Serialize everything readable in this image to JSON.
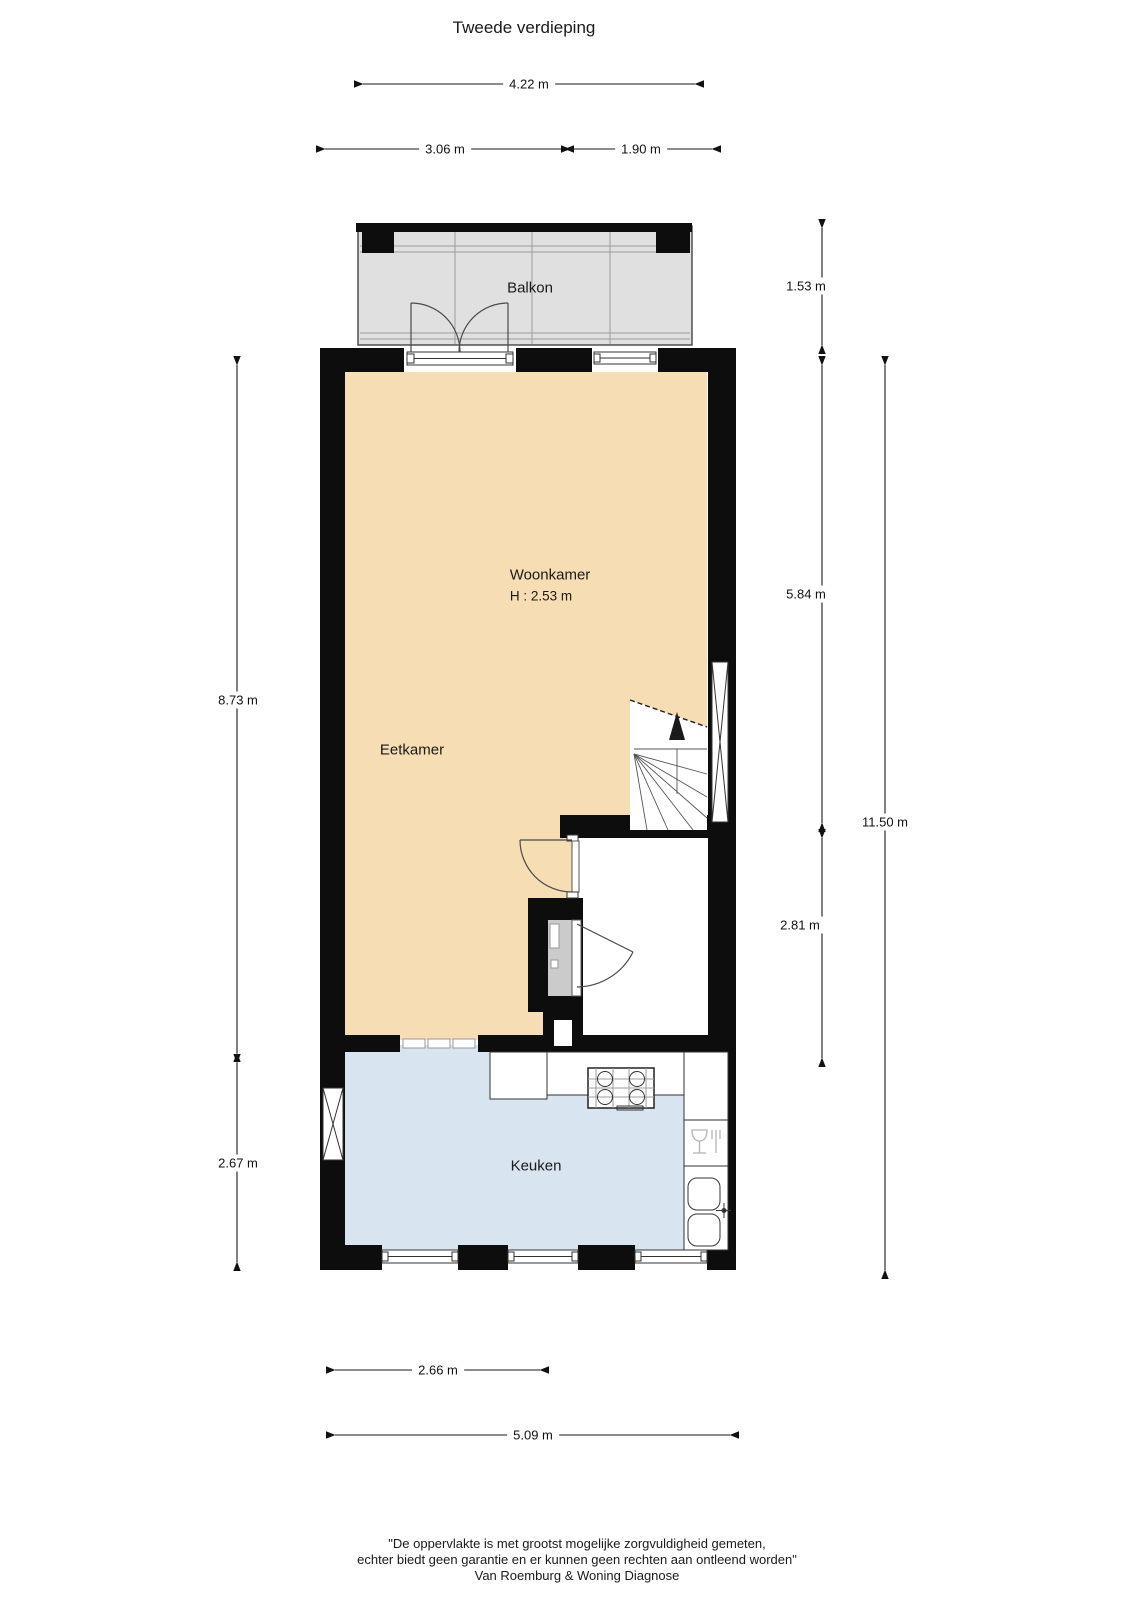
{
  "title": "Tweede verdieping",
  "rooms": {
    "balcony": "Balkon",
    "living": "Woonkamer",
    "living_ceiling_height": "H : 2.53 m",
    "dining": "Eetkamer",
    "kitchen": "Keuken"
  },
  "dims": {
    "balcony_width_total": "4.22 m",
    "balcony_width_left": "3.06 m",
    "balcony_width_right": "1.90 m",
    "balcony_depth": "1.53 m",
    "living_depth_left": "8.73 m",
    "kitchen_depth_left": "2.67 m",
    "living_depth_right": "5.84 m",
    "landing_depth_right": "2.81 m",
    "total_depth_right": "11.50 m",
    "kitchen_width_bottom": "2.66 m",
    "total_width_bottom": "5.09 m"
  },
  "footer": {
    "line1": "\"De oppervlakte is met grootst mogelijke zorgvuldigheid gemeten,",
    "line2": "echter biedt geen garantie en er kunnen geen rechten aan ontleend worden\"",
    "line3": "Van Roemburg & Woning Diagnose"
  },
  "colors": {
    "wall": "#0d0d0d",
    "living-fill": "#f6ddb4",
    "kitchen-fill": "#d9e4f1",
    "balcony-fill": "#e0e0e0",
    "closet-fill": "#cbcbcb",
    "dim-line": "#1a1a1a"
  },
  "icons": {
    "stairs_up_arrow": "filled-triangle-up",
    "stove": "gas-hob-4-burner",
    "sink": "double-basin-sink",
    "dishwasher": "glass-and-fork",
    "window_cross": "elongated-x"
  }
}
